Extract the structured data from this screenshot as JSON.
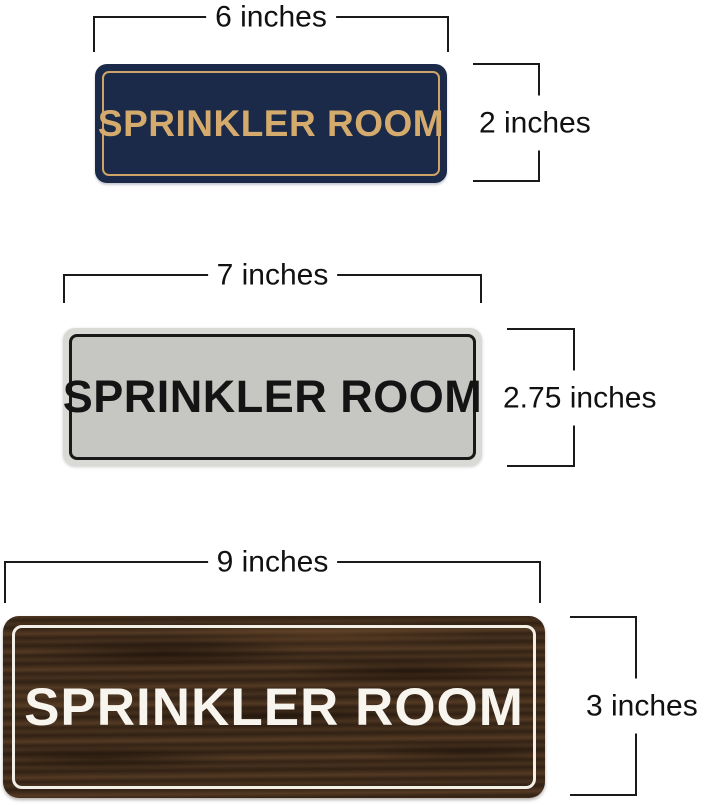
{
  "image_type": "product-size-comparison-diagram",
  "background_color": "#ffffff",
  "dimension_line_color": "#1a1a1a",
  "signs": [
    {
      "style": "navy-gold",
      "text": "SPRINKLER ROOM",
      "width_label": "6 inches",
      "height_label": "2 inches",
      "colors": {
        "background": "#1b2a49",
        "border": "#cda466",
        "text": "#d4ab6c"
      }
    },
    {
      "style": "silver-black",
      "text": "SPRINKLER ROOM",
      "width_label": "7 inches",
      "height_label": "2.75 inches",
      "colors": {
        "frame": "#d9dad6",
        "background": "#c6c7c3",
        "border": "#191919",
        "text": "#141414"
      }
    },
    {
      "style": "walnut-wood-white",
      "text": "SPRINKLER ROOM",
      "width_label": "9 inches",
      "height_label": "3 inches",
      "colors": {
        "background": "#45301f",
        "border": "#f2efe7",
        "text": "#f8f5ef"
      }
    }
  ]
}
